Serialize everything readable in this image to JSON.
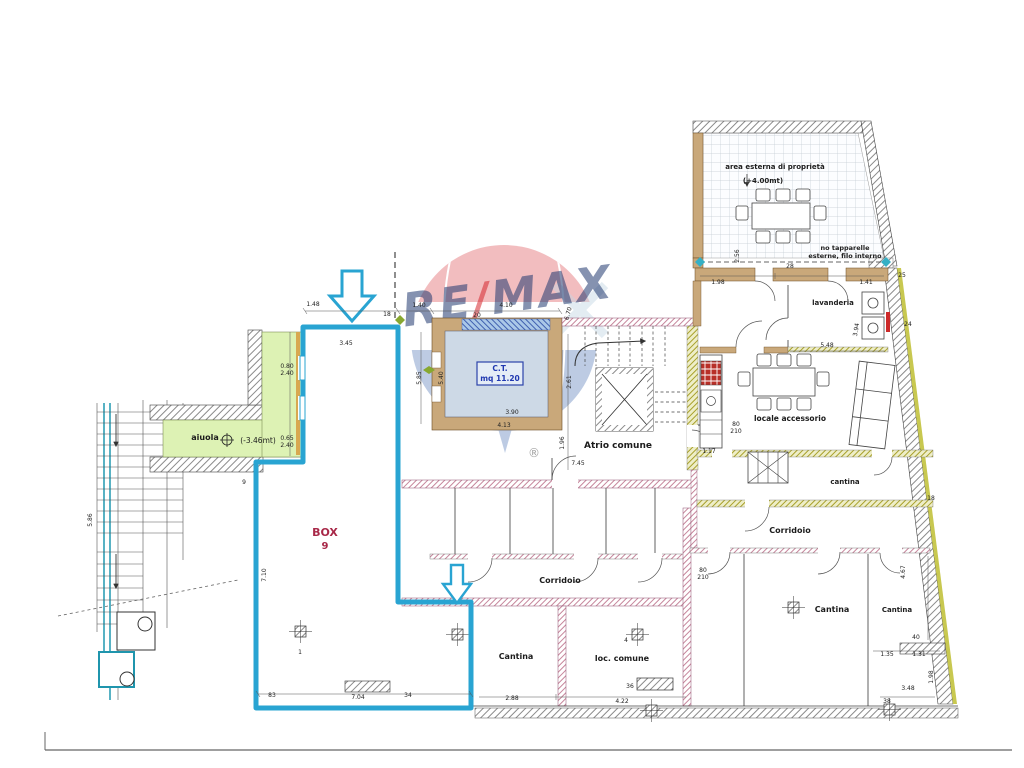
{
  "logo": {
    "re": "RE",
    "slash": "/",
    "max": "MAX",
    "registered": "®"
  },
  "labels": {
    "aiuola": "aiuola",
    "aiuola_level": "(-3.46mt)",
    "box": "BOX",
    "box_number": "9",
    "ct_title": "C.T.",
    "ct_area": "mq 11.20",
    "atrio": "Atrio comune",
    "corridoio_center": "Corridoio",
    "corridoio_right": "Corridoio",
    "cantina_bottom": "Cantina",
    "loc_comune": "loc. comune",
    "cantina_right": "Cantina",
    "cantina_far_right": "Cantina",
    "cantina_small": "cantina",
    "locale_accessorio": "locale accessorio",
    "lavanderia": "lavanderia",
    "terrace_title": "area esterna di proprietà",
    "terrace_level": "(+4.00mt)",
    "terrace_note_1": "no tapparelle",
    "terrace_note_2": "esterne, filo interno"
  },
  "dimensions": [
    {
      "t": "1.48",
      "x": 313,
      "y": 306
    },
    {
      "t": "1.40",
      "x": 419,
      "y": 307
    },
    {
      "t": "4.10",
      "x": 506,
      "y": 307
    },
    {
      "t": "20",
      "x": 477,
      "y": 317
    },
    {
      "t": "3.45",
      "x": 346,
      "y": 345
    },
    {
      "t": "4.13",
      "x": 504,
      "y": 427
    },
    {
      "t": "3.90",
      "x": 512,
      "y": 414
    },
    {
      "t": "5.40",
      "x": 443,
      "y": 378,
      "r": -90
    },
    {
      "t": "5.85",
      "x": 421,
      "y": 378,
      "r": -90
    },
    {
      "t": "6.70",
      "x": 570,
      "y": 314,
      "r": -75
    },
    {
      "t": "2.61",
      "x": 571,
      "y": 382,
      "r": -90
    },
    {
      "t": "1.96",
      "x": 564,
      "y": 443,
      "r": -90
    },
    {
      "t": "7.45",
      "x": 578,
      "y": 465
    },
    {
      "t": "18",
      "x": 387,
      "y": 316
    },
    {
      "t": "9",
      "x": 244,
      "y": 484
    },
    {
      "t": "0.80",
      "x": 287,
      "y": 368
    },
    {
      "t": "2.40",
      "x": 287,
      "y": 375
    },
    {
      "t": "0.65",
      "x": 287,
      "y": 440
    },
    {
      "t": "2.40",
      "x": 287,
      "y": 447
    },
    {
      "t": "7.10",
      "x": 266,
      "y": 575,
      "r": -90
    },
    {
      "t": "5.86",
      "x": 92,
      "y": 520,
      "r": -90
    },
    {
      "t": "83",
      "x": 272,
      "y": 697
    },
    {
      "t": "7.04",
      "x": 358,
      "y": 699
    },
    {
      "t": "34",
      "x": 408,
      "y": 697
    },
    {
      "t": "2.88",
      "x": 512,
      "y": 700
    },
    {
      "t": "4.22",
      "x": 622,
      "y": 703
    },
    {
      "t": "36",
      "x": 630,
      "y": 688
    },
    {
      "t": "1",
      "x": 300,
      "y": 654
    },
    {
      "t": "4",
      "x": 626,
      "y": 642
    },
    {
      "t": "1.17",
      "x": 709,
      "y": 453
    },
    {
      "t": "5.48",
      "x": 827,
      "y": 347
    },
    {
      "t": "3.94",
      "x": 858,
      "y": 330,
      "r": -80
    },
    {
      "t": "24",
      "x": 908,
      "y": 326
    },
    {
      "t": "18",
      "x": 931,
      "y": 500
    },
    {
      "t": "40",
      "x": 916,
      "y": 639
    },
    {
      "t": "1.31",
      "x": 919,
      "y": 656
    },
    {
      "t": "1.35",
      "x": 887,
      "y": 656
    },
    {
      "t": "3.48",
      "x": 908,
      "y": 690
    },
    {
      "t": "38",
      "x": 887,
      "y": 703
    },
    {
      "t": "1.98",
      "x": 933,
      "y": 677,
      "r": -90
    },
    {
      "t": "4.67",
      "x": 905,
      "y": 572,
      "r": -90
    },
    {
      "t": "2.56",
      "x": 739,
      "y": 256,
      "r": -90
    },
    {
      "t": "28",
      "x": 790,
      "y": 268
    },
    {
      "t": "1.98",
      "x": 718,
      "y": 284
    },
    {
      "t": "1.41",
      "x": 866,
      "y": 284
    },
    {
      "t": "25",
      "x": 902,
      "y": 277
    },
    {
      "t": "80",
      "x": 703,
      "y": 572
    },
    {
      "t": "210",
      "x": 703,
      "y": 579
    },
    {
      "t": "80",
      "x": 736,
      "y": 426
    },
    {
      "t": "210",
      "x": 736,
      "y": 433
    }
  ],
  "colors": {
    "cyan_outline": "#29a4d2",
    "aiuola_green": "#ddf2b4",
    "wall_tan": "#c9a87a",
    "wall_mauve": "#b05878",
    "wall_olive": "#b0b040",
    "stove_red": "#b83028",
    "box_label_red": "#a82848",
    "ct_label_blue": "#2038b0",
    "logo_red": "#d6272e",
    "logo_blue": "#2857a4",
    "logo_navy": "#223a70"
  }
}
